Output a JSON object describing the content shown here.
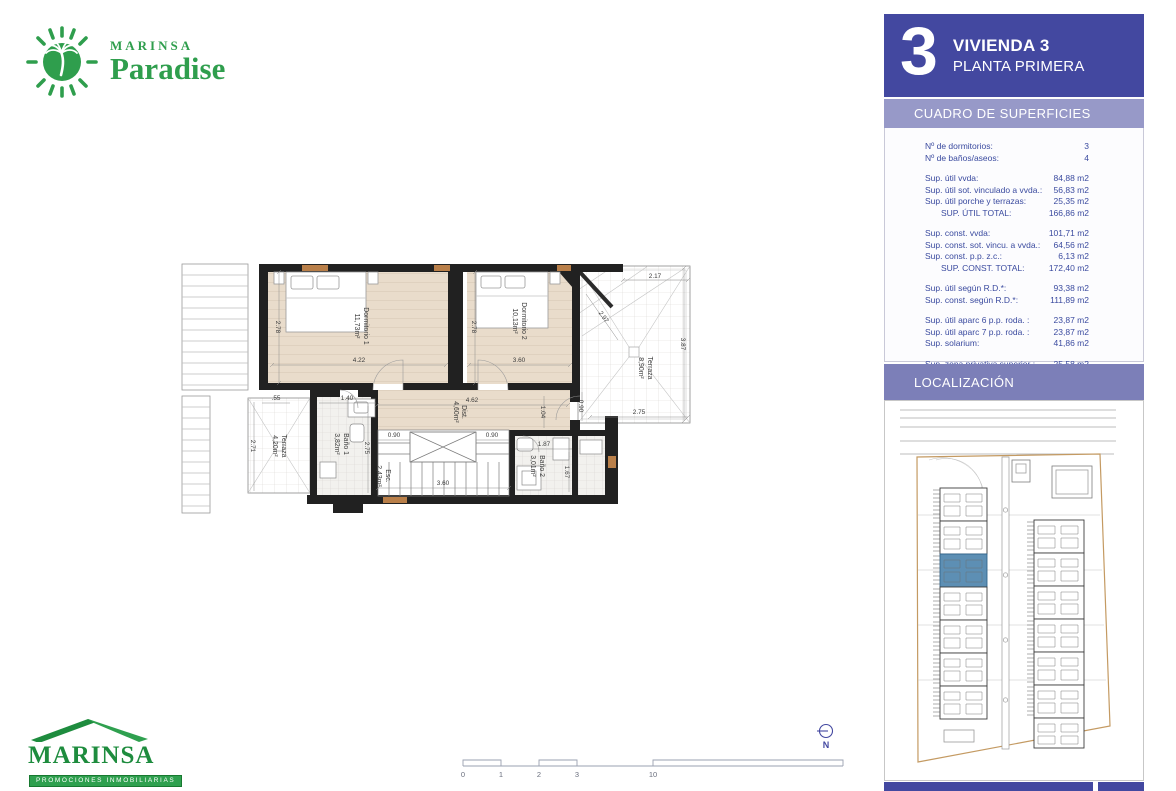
{
  "brand": {
    "top_logo": {
      "name": "MARINSA",
      "product": "Paradise"
    },
    "bottom_logo": {
      "name": "MARINSA",
      "tagline": "PROMOCIONES INMOBILIARIAS"
    }
  },
  "sidebar": {
    "unit_number": "3",
    "title": "VIVIENDA 3",
    "subtitle": "PLANTA PRIMERA",
    "surfaces_header": "CUADRO DE SUPERFICIES",
    "location_header": "LOCALIZACIÓN",
    "surface_table": {
      "groups": [
        {
          "rows": [
            {
              "label": "Nº de dormitorios:",
              "value": "3"
            },
            {
              "label": "Nº de baños/aseos:",
              "value": "4"
            }
          ]
        },
        {
          "rows": [
            {
              "label": "Sup. útil vvda:",
              "value": "84,88 m2"
            },
            {
              "label": "Sup. útil sot. vinculado a vvda.:",
              "value": "56,83 m2"
            },
            {
              "label": "Sup. útil porche y terrazas:",
              "value": "25,35 m2"
            },
            {
              "label": "SUP. ÚTIL TOTAL:",
              "value": "166,86 m2"
            }
          ]
        },
        {
          "rows": [
            {
              "label": "Sup. const. vvda:",
              "value": "101,71 m2"
            },
            {
              "label": "Sup. const. sot. vincu. a vvda.:",
              "value": "64,56 m2"
            },
            {
              "label": "Sup. const. p.p. z.c.:",
              "value": "6,13 m2"
            },
            {
              "label": "SUP. CONST. TOTAL:",
              "value": "172,40 m2"
            }
          ]
        },
        {
          "rows": [
            {
              "label": "Sup. útil según R.D.*:",
              "value": "93,38 m2"
            },
            {
              "label": "Sup. const. según R.D.*:",
              "value": "111,89 m2"
            }
          ]
        },
        {
          "rows": [
            {
              "label": "Sup. útil aparc 6 p.p. roda. :",
              "value": "23,87 m2"
            },
            {
              "label": "Sup. útil aparc 7 p.p. roda. :",
              "value": "23,87 m2"
            },
            {
              "label": "Sup. solarium:",
              "value": "41,86 m2"
            }
          ]
        },
        {
          "rows": [
            {
              "label": "Sup. zona privativa superior :",
              "value": "25,58 m2"
            },
            {
              "label": "Sup. zona privativa inferior:",
              "value": "26,54 m2"
            },
            {
              "label": "Sup. privativa total de parcela:",
              "value": "129,57 m2"
            }
          ]
        }
      ]
    }
  },
  "plan": {
    "rooms": {
      "dorm1": {
        "name": "Dormitorio 1",
        "area": "11,73m²"
      },
      "dorm2": {
        "name": "Dormitorio 2",
        "area": "10,13m²"
      },
      "terraza_right": {
        "name": "Terraza",
        "area": "8,90m²"
      },
      "terraza_left": {
        "name": "Terraza",
        "area": "4,20m²"
      },
      "bano1": {
        "name": "Baño 1",
        "area": "3,82m²"
      },
      "bano2": {
        "name": "Baño 2",
        "area": "3,01m²"
      },
      "dist": {
        "name": "Dist.",
        "area": "4,60m²"
      },
      "esc": {
        "name": "Esc.",
        "area": "2,43m²"
      }
    },
    "dims": {
      "dorm1_w": "4.22",
      "dorm1_h": "2.78",
      "dorm2_w": "3.60",
      "dorm2_h": "2.78",
      "tr_top": "2.17",
      "tr_diag": "2.97",
      "tr_right": "3.87",
      "tr_bottom": "2.75",
      "tr_left": "0.90",
      "dist_w": "4.62",
      "dist_h": "1.04",
      "bano1_w": "1.40",
      "bano1_h": "2.75",
      "tl_top": ".55",
      "tl_left": "2.71",
      "esc_l": "0.90",
      "esc_r": "0.90",
      "esc_w": "3.60",
      "bano2_w": "1.87",
      "bano2_h": "1.67"
    }
  },
  "scalebar": {
    "labels": [
      "0",
      "1",
      "2",
      "3",
      "5",
      "10"
    ]
  },
  "north_label": "N",
  "colors": {
    "brand_green": "#2f9e4d",
    "sidebar_blue": "#4348a0",
    "band_light": "#9799c8",
    "band_mid": "#7c7fb8",
    "table_text": "#3a4a9f",
    "highlight_blue": "#5d8fb4",
    "parcel_orange": "#c49a62"
  }
}
